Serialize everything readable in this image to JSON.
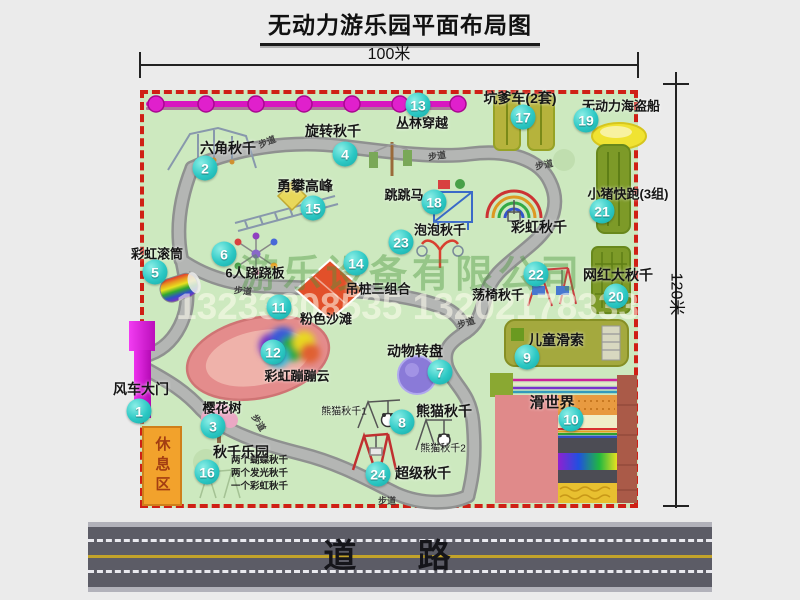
{
  "title": "无动力游乐园平面布局图",
  "dimensions": {
    "width": "100米",
    "height": "120米"
  },
  "road_label": "道 路",
  "path_label": "步道",
  "rest_area_label": "休息区",
  "rainbow_swing_label": "彩虹秋千",
  "watermark": {
    "company": "游乐设备有限公司",
    "phone": "13233808535 13202178333"
  },
  "panda_swing_notes": [
    "熊猫秋千1",
    "熊猫秋千2"
  ],
  "swing_park_notes": [
    "两个蝴蝶秋千",
    "两个发光秋千",
    "一个彩虹秋千"
  ],
  "items": [
    {
      "num": "1",
      "label": "风车大门"
    },
    {
      "num": "2",
      "label": "六角秋千"
    },
    {
      "num": "3",
      "label": "樱花树"
    },
    {
      "num": "4",
      "label": "旋转秋千"
    },
    {
      "num": "5",
      "label": "彩虹滚筒"
    },
    {
      "num": "6",
      "label": "6人跷跷板"
    },
    {
      "num": "7",
      "label": "动物转盘"
    },
    {
      "num": "8",
      "label": "熊猫秋千"
    },
    {
      "num": "9",
      "label": "儿童滑索"
    },
    {
      "num": "10",
      "label": "滑世界"
    },
    {
      "num": "11",
      "label": "粉色沙滩"
    },
    {
      "num": "12",
      "label": "彩虹蹦蹦云"
    },
    {
      "num": "13",
      "label": "丛林穿越"
    },
    {
      "num": "14",
      "label": "吊桩三组合"
    },
    {
      "num": "15",
      "label": "勇攀高峰"
    },
    {
      "num": "16",
      "label": "秋千乐园"
    },
    {
      "num": "17",
      "label": "坑爹车(2套)"
    },
    {
      "num": "18",
      "label": "跳跳马"
    },
    {
      "num": "19",
      "label": "无动力海盗船"
    },
    {
      "num": "20",
      "label": "网红大秋千"
    },
    {
      "num": "21",
      "label": "小猪快跑(3组)"
    },
    {
      "num": "22",
      "label": "荡椅秋千"
    },
    {
      "num": "23",
      "label": "泡泡秋千"
    },
    {
      "num": "24",
      "label": "超级秋千"
    }
  ],
  "colors": {
    "map_border": "#cf2015",
    "map_bg": "#cde9bf",
    "zipline": "#e020cc",
    "number_circle": "#2cc8c4",
    "road": "#5c5c66"
  }
}
